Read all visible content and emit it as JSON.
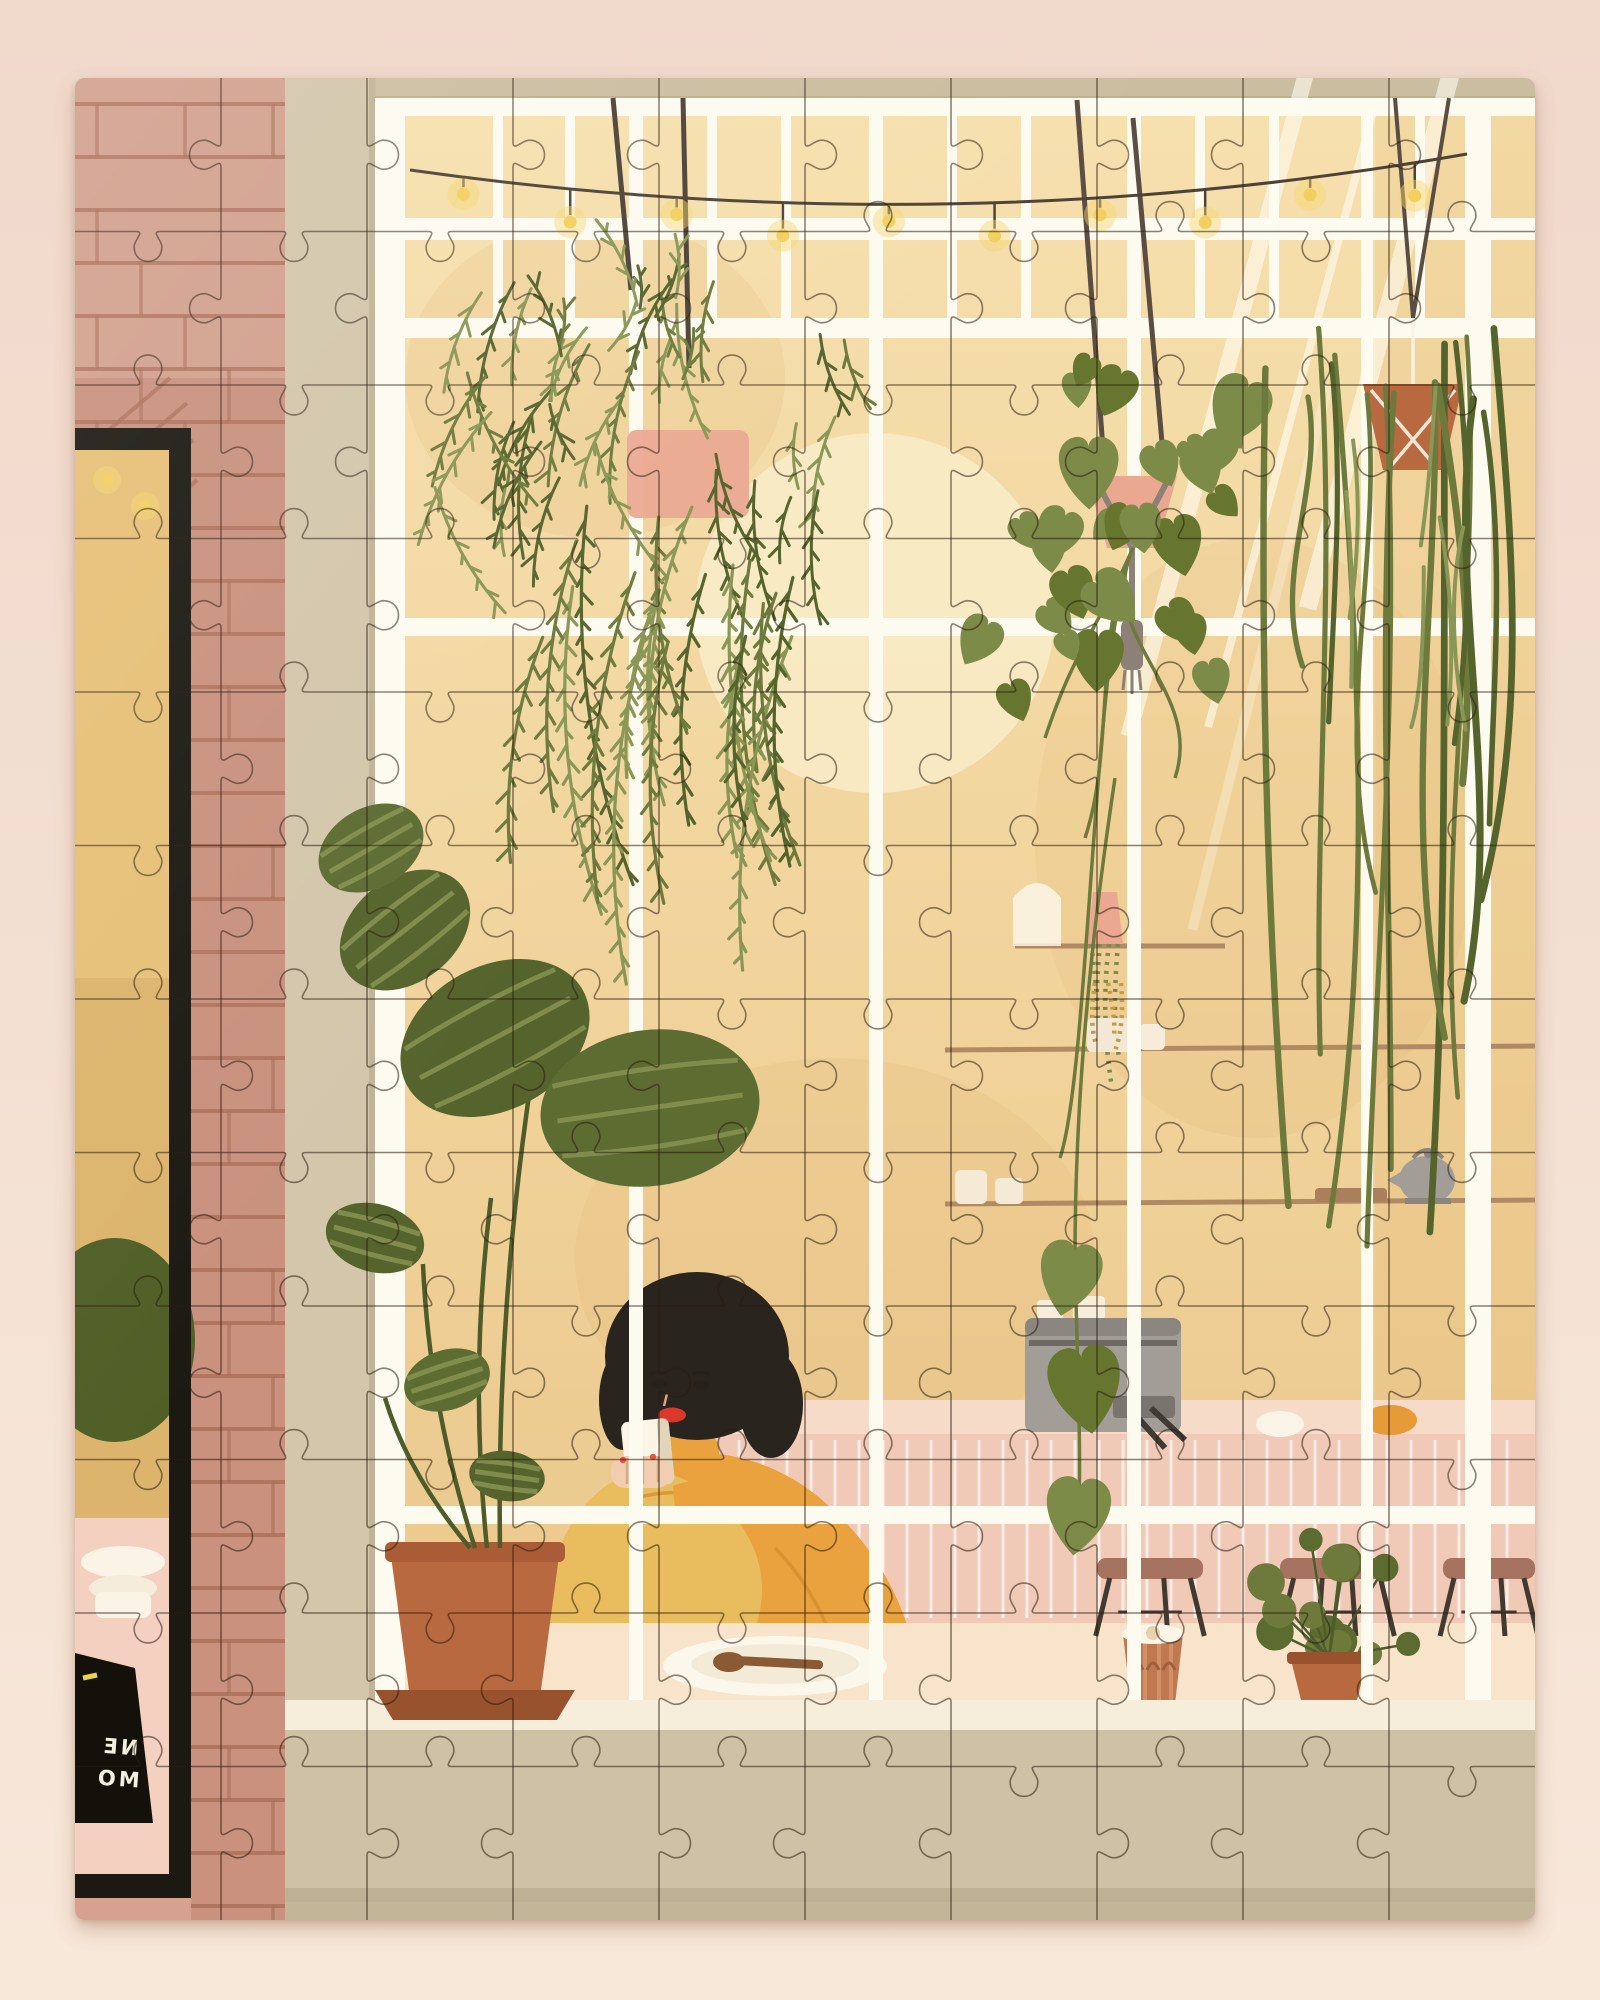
{
  "scene": {
    "description": "Photograph of a completed jigsaw puzzle on a pale pink surface. The puzzle artwork is an illustration of a woman with a black bob and mustard sweater drinking coffee behind a large white-gridded cafe window, surrounded by hanging plants, string lights, shelves, an espresso machine, stools and potted plants, next to a brick wall.",
    "sign": {
      "mirrored_lines": [
        "NE",
        "MO"
      ]
    },
    "puzzle": {
      "cols": 10,
      "rows": 12,
      "piece_count": 120
    },
    "lights": {
      "bulb_count": 10
    }
  },
  "palette": {
    "backdrop_top": "#f0d9cb",
    "backdrop_bottom": "#f8e8da",
    "tan_band": "#cbbd9f",
    "brick": "#c9917e",
    "brick_line": "#a96e57",
    "brick_light": "#dcb09c",
    "frame": "#d3c6ab",
    "lower_wall": "#cec1a5",
    "pane": "#f3d9a2",
    "pane_deep": "#eac68b",
    "mullion": "#fdfaf0",
    "sun": "#f8ebc6",
    "left_window": "#e6c077",
    "frame_black": "#1c1913",
    "sign": "#14110a",
    "sign_text": "#f3efe2",
    "leaf_olive": "#6d7a3c",
    "leaf_dark": "#55642c",
    "leaf_pothos": "#7d8b49",
    "leaf_pale": "#8a9655",
    "pink_pot": "#eaa891",
    "terracotta": "#b8693f",
    "terracotta_dark": "#98522d",
    "counter": "#f0c9b7",
    "counter_top": "#f7dbc9",
    "cream": "#f7e4ca",
    "sill": "#f6eedb",
    "grey": "#a29d96",
    "sweater": "#e9a23d",
    "sweater_light": "#e9bc5e",
    "hair": "#2a241e",
    "skin": "#f2cdb2",
    "lips": "#da382a",
    "wire": "#4d4236",
    "bulb": "#f2cf5f",
    "wood": "#a97f5c",
    "stool": "#a5735f",
    "stool_leg": "#423a30"
  }
}
